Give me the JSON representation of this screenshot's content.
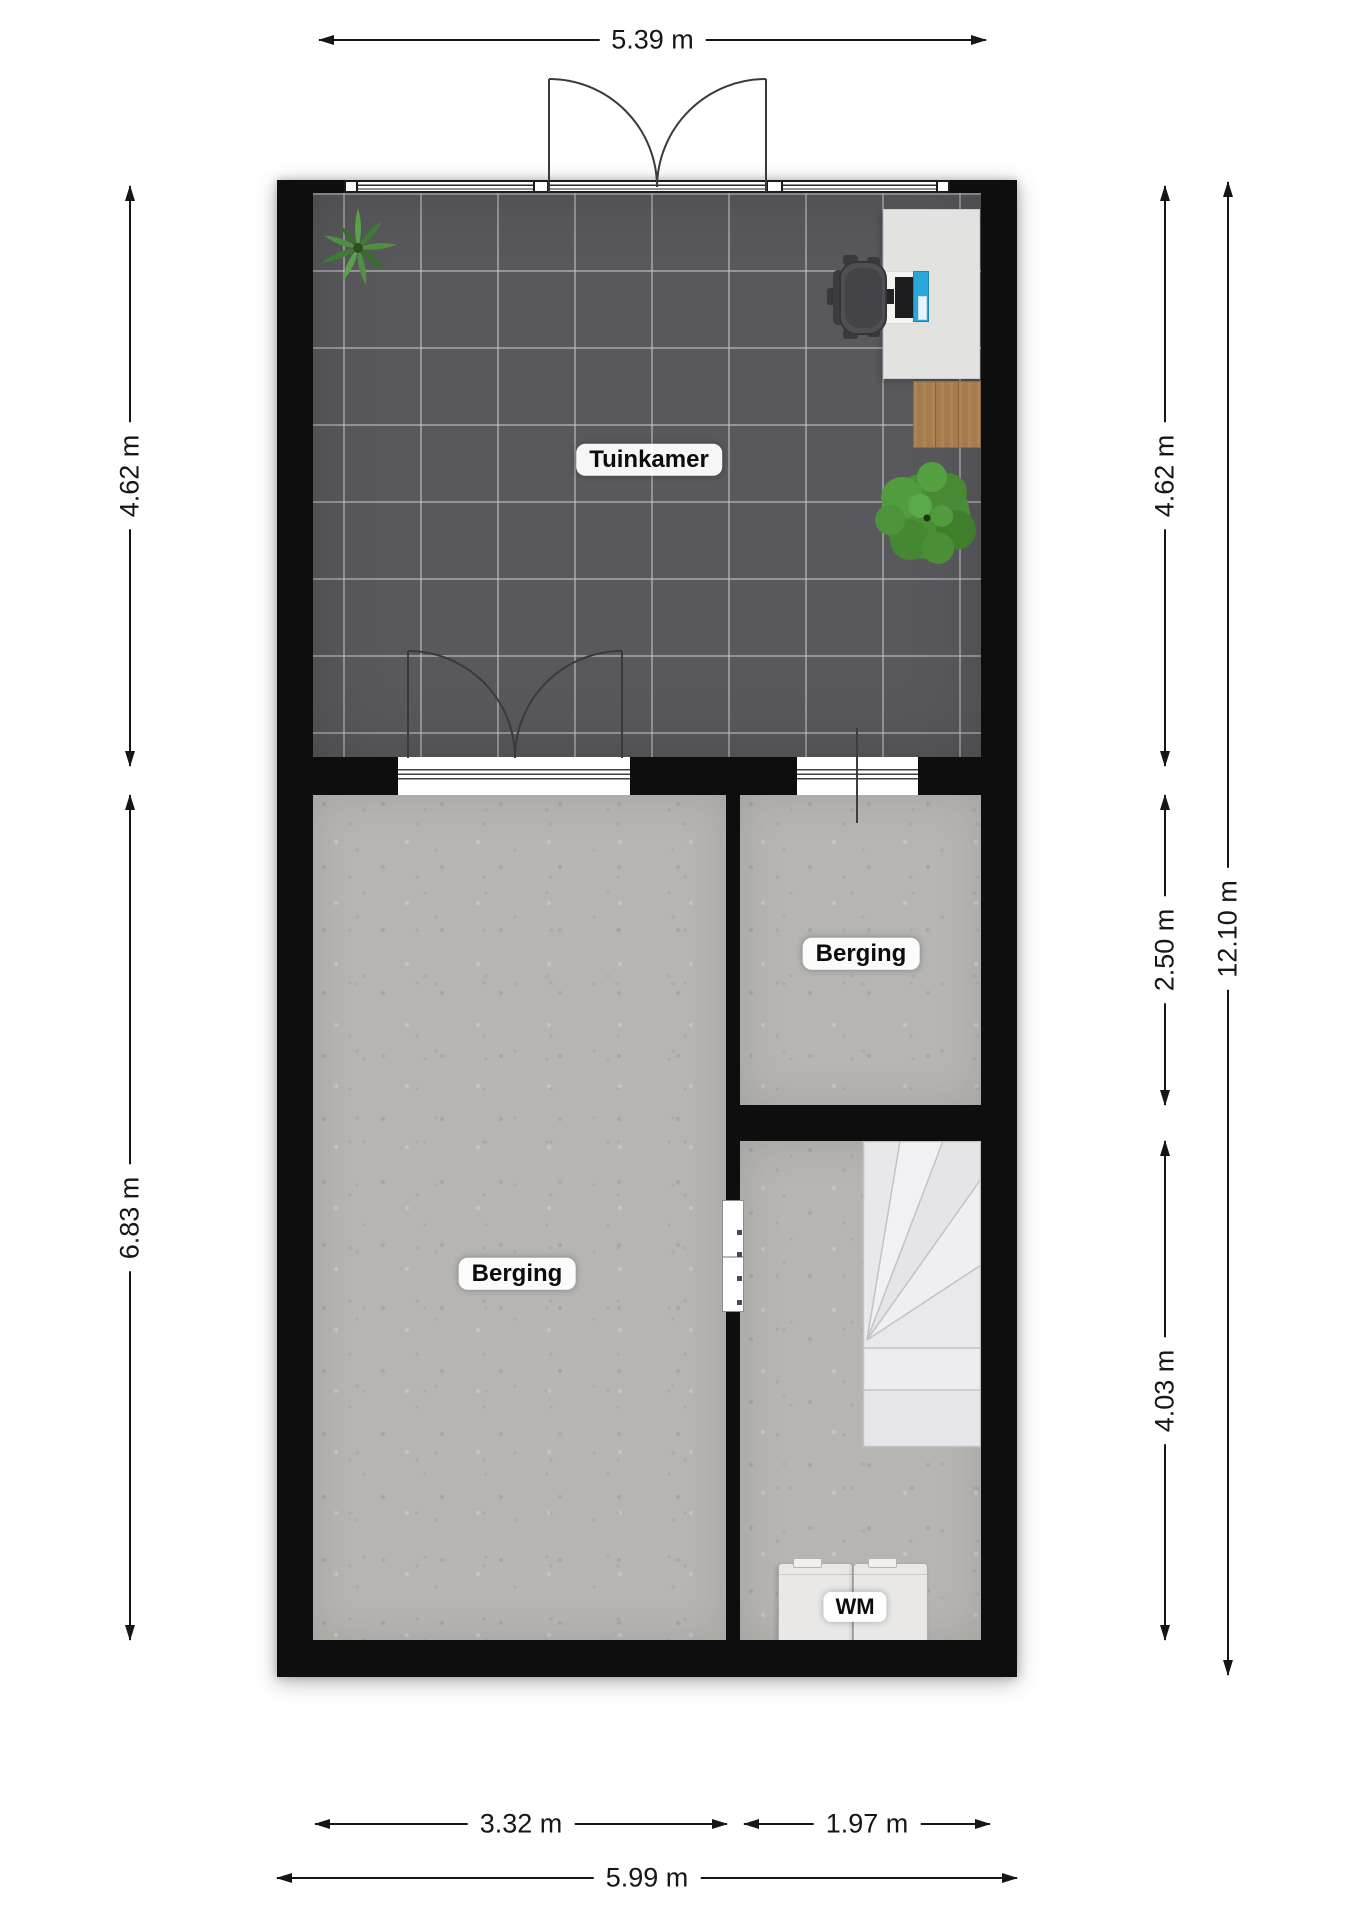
{
  "dimensions": {
    "top_width": "5.39 m",
    "left_top": "4.62 m",
    "left_bottom": "6.83 m",
    "right_top": "4.62 m",
    "right_middle": "2.50 m",
    "right_bottom": "4.03 m",
    "right_total": "12.10 m",
    "bottom_left": "3.32 m",
    "bottom_middle": "1.97 m",
    "bottom_total": "5.99 m"
  },
  "rooms": {
    "tuinkamer": {
      "label": "Tuinkamer"
    },
    "berging_right": {
      "label": "Berging"
    },
    "berging_left": {
      "label": "Berging"
    },
    "washing_machine": {
      "label": "WM"
    }
  },
  "icons": {
    "plant_top_left": "agave-plant-icon",
    "plant_bottom_right": "bush-plant-icon",
    "office_chair": "office-chair-icon",
    "desk_computer": "computer-icon",
    "staircase": "staircase-icon",
    "washing_machines": "washing-machine-icon"
  },
  "colors": {
    "wall": "#0e0e0e",
    "tile_floor": "#59595d",
    "tile_grout": "#c3c3ca",
    "concrete_floor": "#b7b5b2",
    "desk": "#e2e2e0",
    "sideboard_wood": "#a57c4c",
    "stairs": "#ebebed",
    "pc_tower": "#2ba6d9",
    "plant": "#4a8f38",
    "chair": "#4c4c50",
    "dimension_ink": "#161616",
    "label_bg": "#ffffff"
  }
}
